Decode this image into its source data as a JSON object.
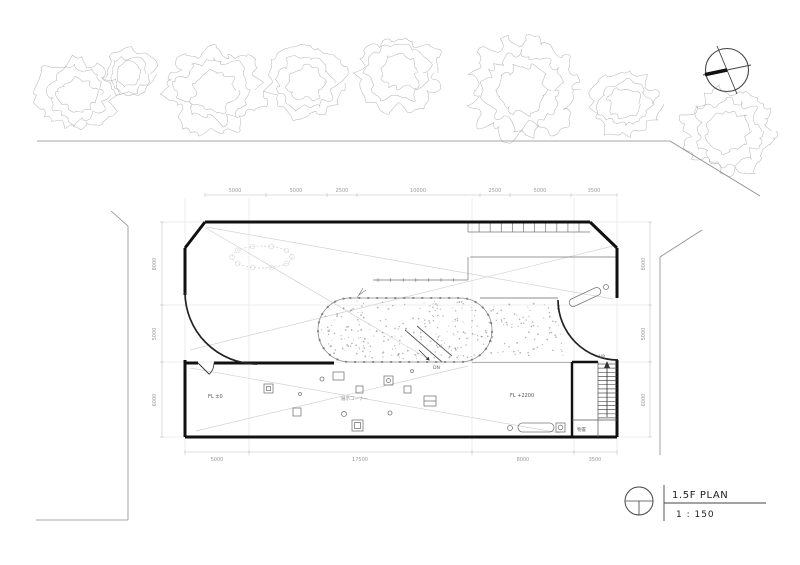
{
  "drawing": {
    "title": "1.5F PLAN",
    "scale": "1 : 150"
  },
  "labels": {
    "floor_level_left": "FL ±0",
    "floor_level_right": "FL +2200",
    "stairs_up": "UP",
    "ramp_down": "DN",
    "storage_room": "物置",
    "area_note": "展示コーナー"
  },
  "dimensions": {
    "top": [
      "5000",
      "5000",
      "2500",
      "10000",
      "2500",
      "5000",
      "3500"
    ],
    "bottom": [
      "5000",
      "17500",
      "8000",
      "3500"
    ],
    "left": [
      "8000",
      "5000",
      "6000"
    ],
    "right": [
      "8000",
      "5000",
      "6000"
    ]
  },
  "icons": {
    "north_arrow": "compass-north-arrow-icon",
    "title_marker": "drawing-reference-circle-icon"
  },
  "colors": {
    "walls": "#111111",
    "thin_lines": "#777777",
    "grid": "#ececec",
    "dim_text": "#9a9a9a",
    "sketch_trees": "#b9b9b9",
    "stipple": "#9a9a9a",
    "sight_lines": "#d2d2d2",
    "site_boundary": "#8a8a8a"
  }
}
